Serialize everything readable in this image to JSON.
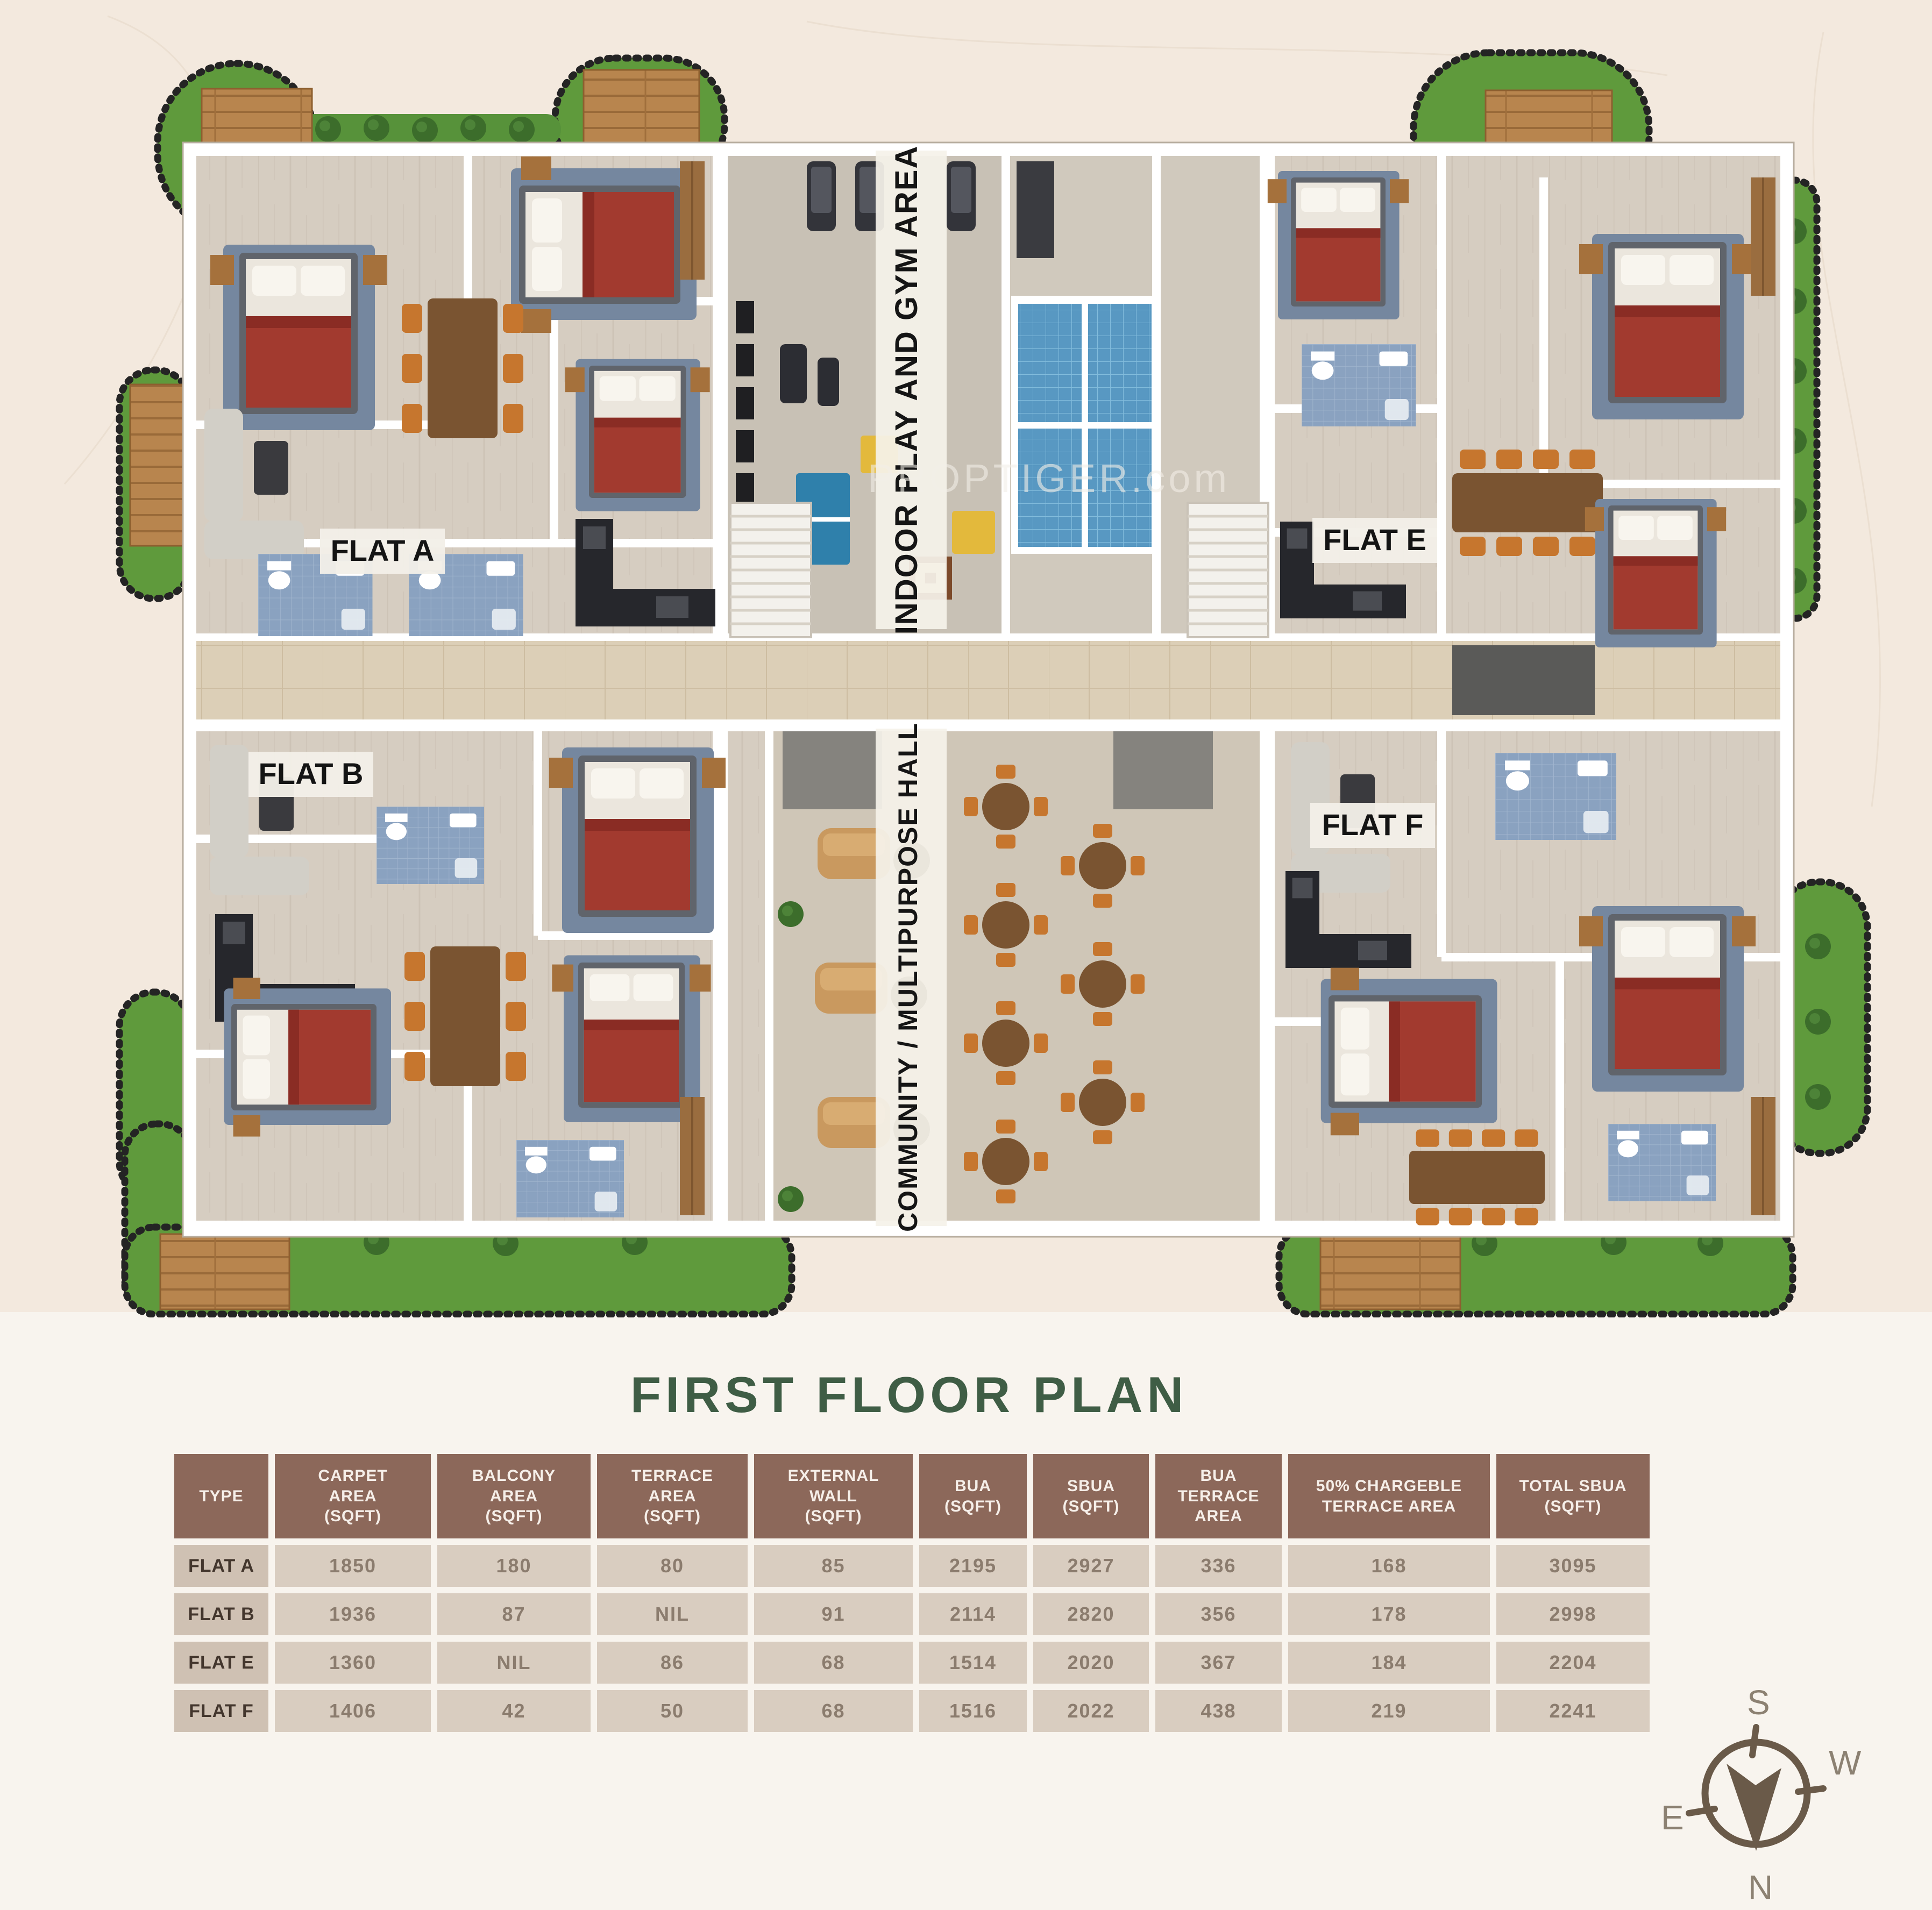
{
  "title": "FIRST FLOOR PLAN",
  "watermark": "PROPTIGER.com",
  "plan": {
    "flat_labels": {
      "a": "FLAT A",
      "b": "FLAT B",
      "e": "FLAT E",
      "f": "FLAT F"
    },
    "gym_label": "INDOOR PLAY AND GYM AREA",
    "hall_label": "COMMUNITY / MULTIPURPOSE HALL"
  },
  "table": {
    "headers": [
      "TYPE",
      "CARPET\nAREA\n(SQFT)",
      "BALCONY\nAREA\n(SQFT)",
      "TERRACE\nAREA\n(SQFT)",
      "EXTERNAL\nWALL\n(SQFT)",
      "BUA\n(SQFT)",
      "SBUA\n(SQFT)",
      "BUA\nTERRACE\nAREA",
      "50% CHARGEBLE\nTERRACE  AREA",
      "TOTAL SBUA\n(SQFT)"
    ],
    "rows": [
      {
        "type": "FLAT A",
        "values": [
          "1850",
          "180",
          "80",
          "85",
          "2195",
          "2927",
          "336",
          "168",
          "3095"
        ]
      },
      {
        "type": "FLAT B",
        "values": [
          "1936",
          "87",
          "NIL",
          "91",
          "2114",
          "2820",
          "356",
          "178",
          "2998"
        ]
      },
      {
        "type": "FLAT E",
        "values": [
          "1360",
          "NIL",
          "86",
          "68",
          "1514",
          "2020",
          "367",
          "184",
          "2204"
        ]
      },
      {
        "type": "FLAT F",
        "values": [
          "1406",
          "42",
          "50",
          "68",
          "1516",
          "2022",
          "438",
          "219",
          "2241"
        ]
      }
    ]
  },
  "compass": {
    "top": "S",
    "right": "W",
    "left": "E",
    "bottom": "N"
  },
  "colors": {
    "background_cream": "#f3e9de",
    "title_green": "#3f5d45",
    "table_header_brown": "#8c685a",
    "row_label_bg": "#cfc1b3",
    "row_value_bg": "#d9cdc0",
    "grass_green": "#5f9a3c",
    "deck_wood": "#b8854e",
    "bathroom_blue": "#8aa2c0",
    "shower_blue": "#5898c2",
    "bed_red": "#a23a2f",
    "accent_yellow": "#e3b93c",
    "floor_beige": "#d6cdc1",
    "corridor_beige": "#dccfb7",
    "compass_brown": "#6a5a49"
  }
}
